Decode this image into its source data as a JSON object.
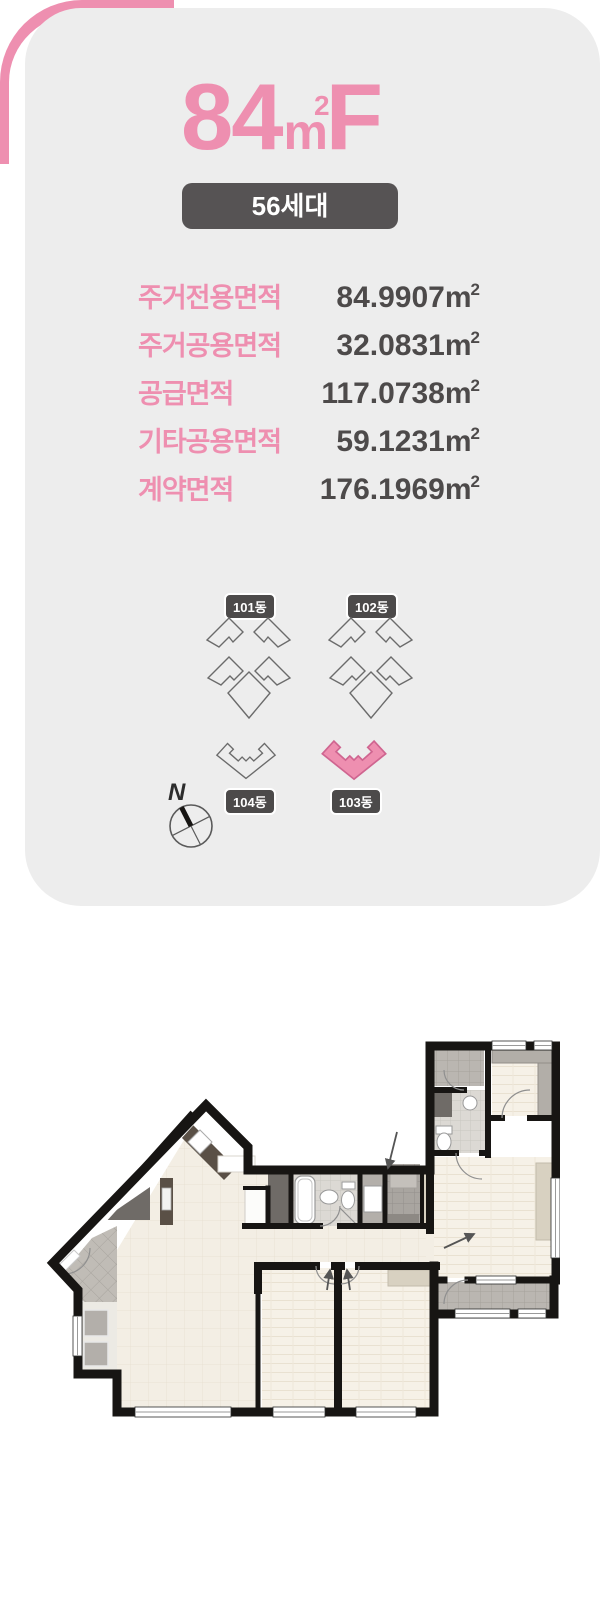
{
  "theme": {
    "pink": "#ee8fb0",
    "pink_deep": "#cf6590",
    "card_bg": "#ededed",
    "badge_bg": "#565354",
    "text_dark": "#4d4a4a",
    "outline_gray": "#6b6b6b",
    "wall_black": "#171513"
  },
  "header": {
    "area_number": "84",
    "area_unit": "㎡",
    "unit_m": "m",
    "unit_sup": "2",
    "type_letter": "F",
    "households": "56세대"
  },
  "area_table": {
    "unit": "㎡",
    "unit_m": "m",
    "unit_sup": "2",
    "rows": [
      {
        "label": "주거전용면적",
        "value": "84.9907"
      },
      {
        "label": "주거공용면적",
        "value": "32.0831"
      },
      {
        "label": "공급면적",
        "value": "117.0738"
      },
      {
        "label": "기타공용면적",
        "value": "59.1231"
      },
      {
        "label": "계약면적",
        "value": "176.1969"
      }
    ]
  },
  "site_map": {
    "compass": "N",
    "buildings": [
      {
        "label": "101동",
        "highlighted": false
      },
      {
        "label": "102동",
        "highlighted": false
      },
      {
        "label": "104동",
        "highlighted": false
      },
      {
        "label": "103동",
        "highlighted": true
      }
    ]
  }
}
